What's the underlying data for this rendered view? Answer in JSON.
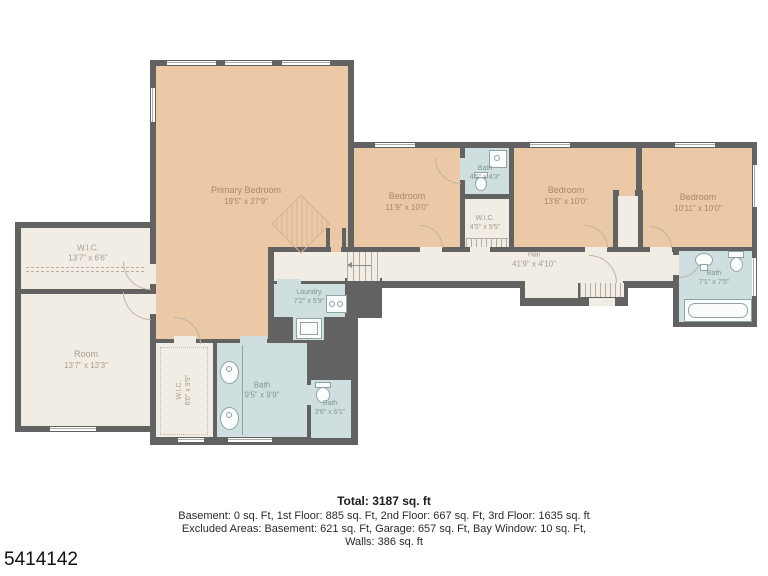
{
  "plan_id": "5414142",
  "colors": {
    "bedroom_fill": "#ecc9a6",
    "bath_fill": "#cfdfdf",
    "neutral_fill": "#f2ede4",
    "wall": "#626262"
  },
  "rooms": {
    "primary_bedroom": {
      "name": "Primary Bedroom",
      "dims": "19'5\" x 27'9\""
    },
    "wic_left": {
      "name": "W.I.C.",
      "dims": "13'7\" x 6'6\""
    },
    "room": {
      "name": "Room",
      "dims": "13'7\" x 13'3\""
    },
    "bedroom_1": {
      "name": "Bedroom",
      "dims": "11'9\" x 10'0\""
    },
    "bath_small": {
      "name": "Bath",
      "dims": "4'5\" x 4'3\""
    },
    "wic_center": {
      "name": "W.I.C.",
      "dims": "4'5\" x 5'5\""
    },
    "bedroom_2": {
      "name": "Bedroom",
      "dims": "13'6\" x 10'0\""
    },
    "bedroom_3": {
      "name": "Bedroom",
      "dims": "10'11\" x 10'0\""
    },
    "bath_right": {
      "name": "Bath",
      "dims": "7'1\" x 7'5\""
    },
    "hall": {
      "name": "Hall",
      "dims": "41'9\" x 4'10\""
    },
    "laundry": {
      "name": "Laundry",
      "dims": "7'2\" x 5'9\""
    },
    "wic_lower": {
      "name": "W.I.C.",
      "dims": "6'0\" x 9'9\""
    },
    "bath_main": {
      "name": "Bath",
      "dims": "9'5\" x 9'9\""
    },
    "bath_lower": {
      "name": "Bath",
      "dims": "3'6\" x 6'1\""
    }
  },
  "footer": {
    "total": "Total: 3187 sq. ft",
    "line1": "Basement: 0 sq. Ft, 1st Floor: 885 sq. Ft, 2nd Floor: 667 sq. Ft, 3rd Floor: 1635 sq. ft",
    "line2": "Excluded Areas: Basement: 621 sq. Ft, Garage: 657 sq. Ft, Bay Window: 10 sq. Ft,",
    "line3": "Walls: 386 sq. ft"
  }
}
